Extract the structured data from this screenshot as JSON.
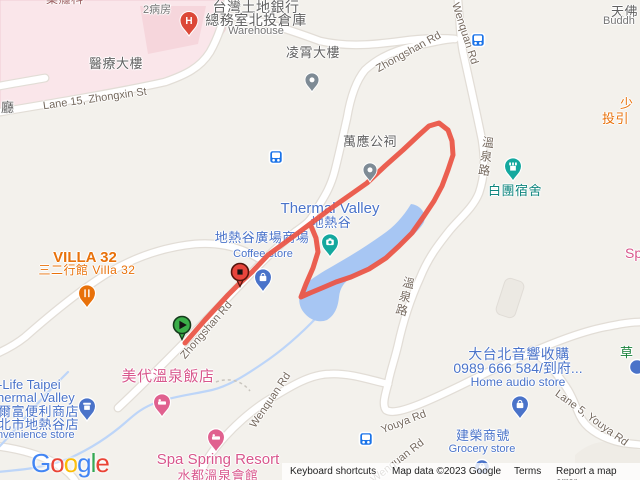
{
  "labels": {
    "pharmacy": "藥癮科",
    "ward2": "2病房",
    "medical_building": "醫療大樓",
    "land_bank_1": "台灣土地銀行",
    "land_bank_2": "總務室北投倉庫",
    "land_bank_3": "Warehouse",
    "lingxiao": "凌霄大樓",
    "wanying": "萬應公祠",
    "thermal_valley": "Thermal Valley",
    "thermal_valley_cn": "地熱谷",
    "plaza": "地熱谷廣場商場",
    "coffee": "Coffee store",
    "baituan": "白團宿舍",
    "villa32": "VILLA 32",
    "villa32_sub": "三二行館 Villa 32",
    "meidai": "美代溫泉飯店",
    "hilife_1": "-Life Taipei",
    "hilife_2": "hermal Valley",
    "hilife_3": "爾富便利商店",
    "hilife_4": "北市地熱谷店",
    "hilife_5": "nvenience store",
    "spa_spring": "Spa Spring Resort",
    "shuidu": "水都溫泉會館",
    "audio_1": "大台北音響收購",
    "audio_2": "0989 666 584/到府...",
    "audio_3": "Home audio store",
    "jianrong": "建榮商號",
    "grocery": "Grocery store",
    "shao_1": "少",
    "shao_2": "投引",
    "sp_partial": "Sp",
    "tianfo": "天佛",
    "buddh": "Buddh",
    "cao": "草",
    "ting": "廳"
  },
  "roads": {
    "zhongshan": "Zhongshan Rd",
    "zhongxin": "Lane 15, Zhongxin St",
    "wenquan": "Wenquan Rd",
    "wenquan_cn": "溫泉路",
    "youya": "Youya Rd",
    "lane5": "Lane 5, Youya Rd"
  },
  "markers": {
    "hospital_glyph": "H"
  },
  "footer": {
    "keyboard": "Keyboard shortcuts",
    "map_data": "Map data ©2023 Google",
    "terms": "Terms",
    "report": "Report a map error"
  },
  "logo": {
    "l1": "G",
    "l2": "o",
    "l3": "o",
    "l4": "g",
    "l5": "l",
    "l6": "e"
  },
  "colors": {
    "route": "#EA5648",
    "water": "#A7C6F3",
    "start_marker": "#3BAE49",
    "end_marker": "#E8453C",
    "shop_blue": "#4A73C9",
    "lodging_pink": "#D8578C",
    "food_orange": "#E8710A",
    "attraction_teal": "#14A89E",
    "bus_blue": "#1A73E8"
  }
}
